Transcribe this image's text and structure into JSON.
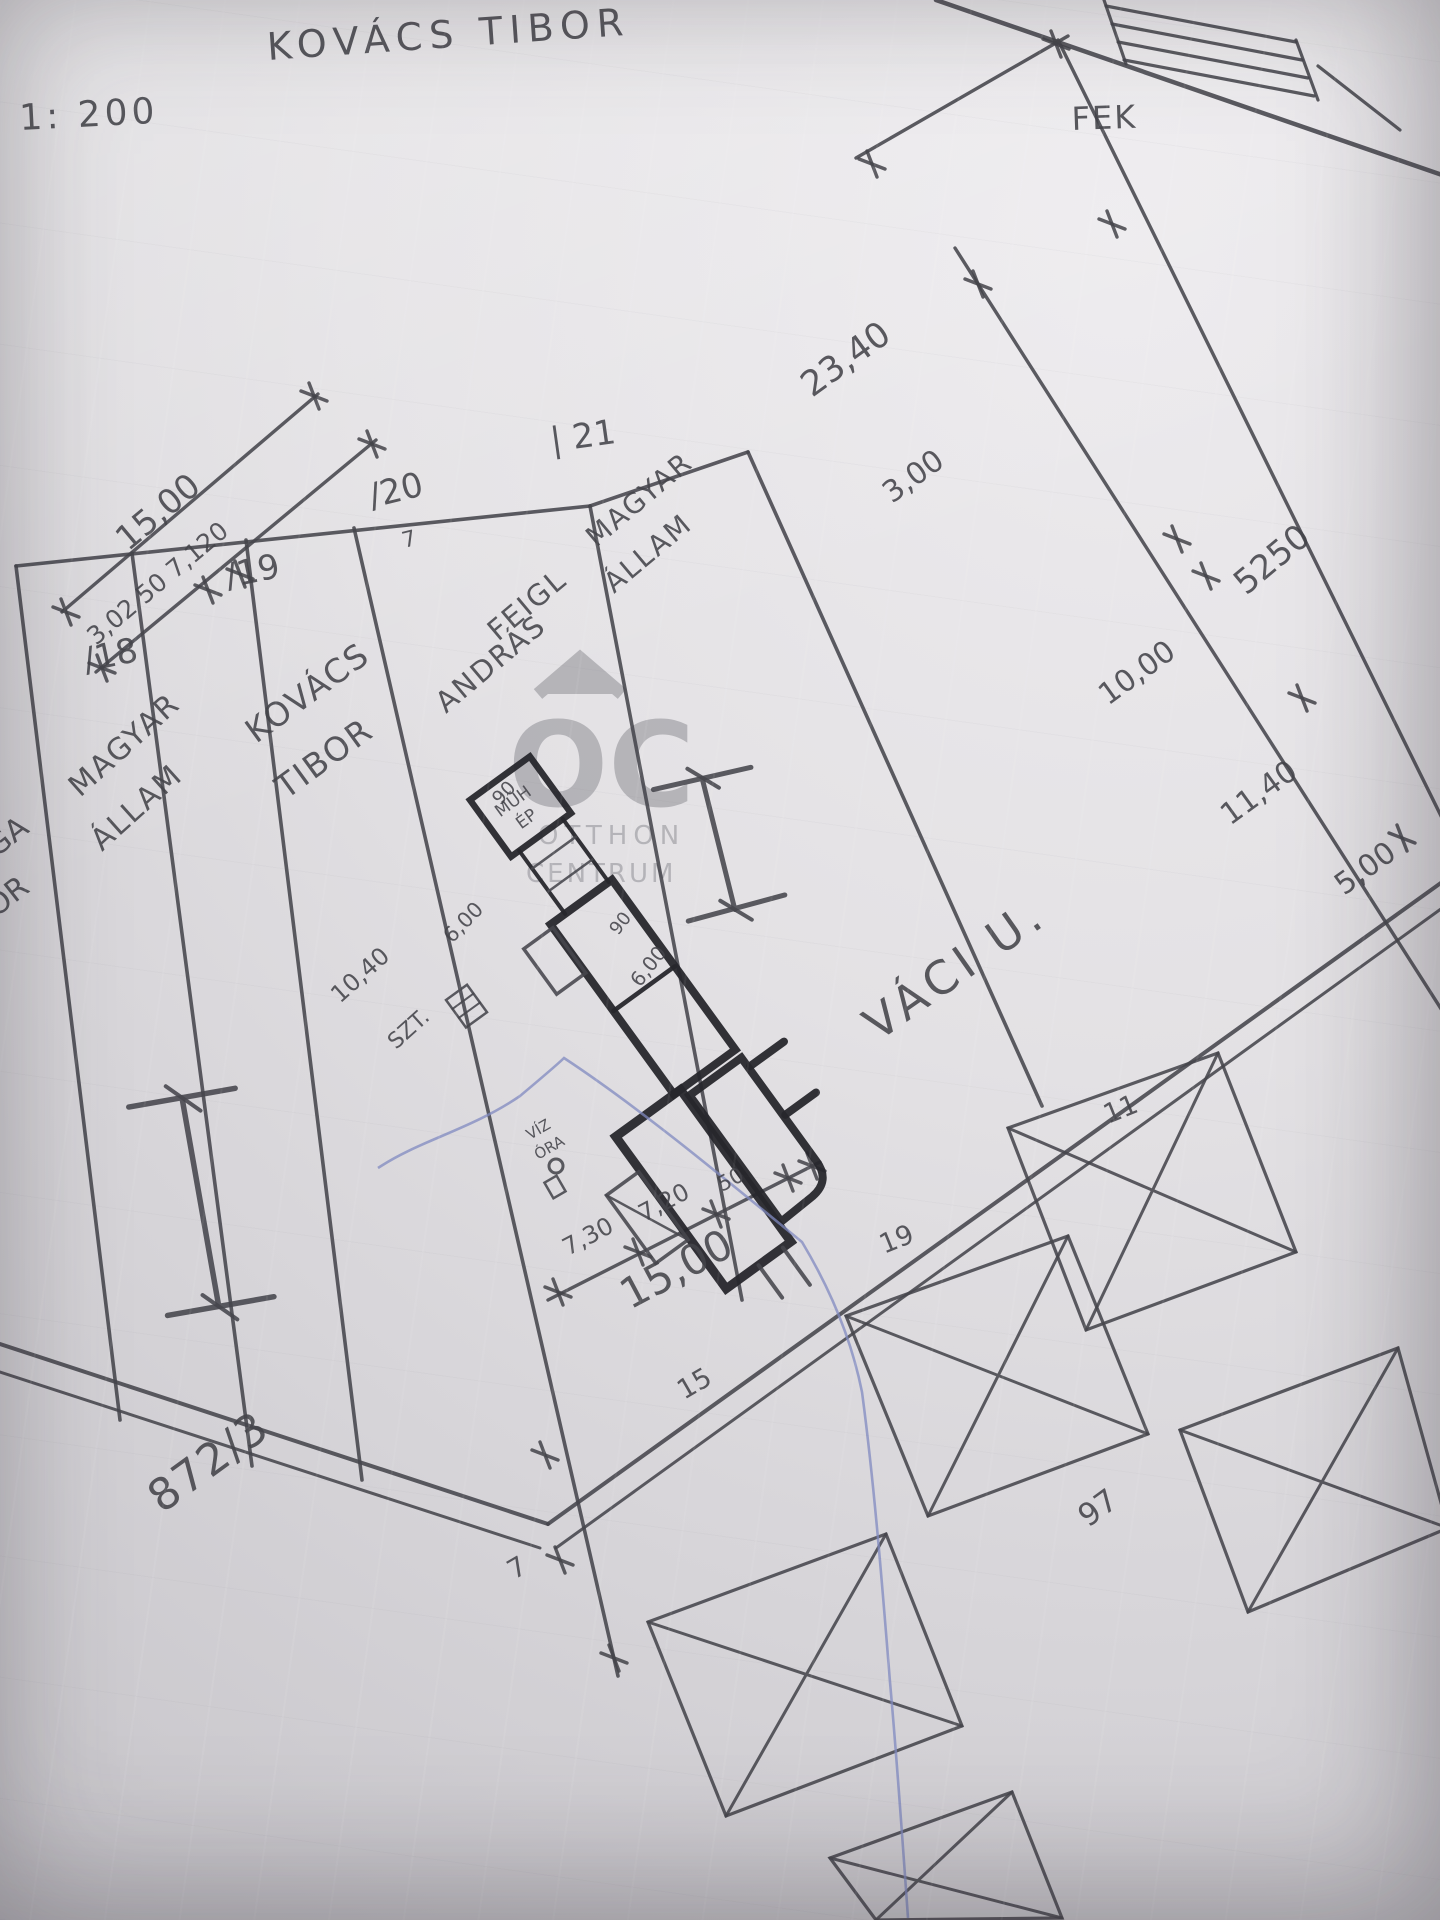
{
  "header": {
    "title": "KOVÁCS TIBOR",
    "scale": "1: 200",
    "corner_note": "FEK"
  },
  "watermark": {
    "monogram": "OC",
    "line1": "OTTHON",
    "line2": "CENTRUM"
  },
  "plots": {
    "p18_number": "/18",
    "p19_number": "/19",
    "p20_number": "/20",
    "p20_sub": "7",
    "p21_number": "| 21",
    "owner_18_line1": "MAGYAR",
    "owner_18_line2": "ÁLLAM",
    "owner_19_line1": "KOVÁCS",
    "owner_19_line2": "TIBOR",
    "owner_20_line1": "FEIGL",
    "owner_20_line2": "ANDRÁS",
    "owner_21_line1": "MAGYAR",
    "owner_21_line2": "ÁLLAM",
    "edge_partial_top": "GA",
    "edge_partial_bottom": "OR",
    "parcel_bottom_left": "872/3",
    "street_name": "VÁCI U.",
    "neighbor_numbers": [
      "11",
      "19",
      "15",
      "7",
      "97"
    ]
  },
  "dimensions": {
    "right_chain": [
      "23,40",
      "3,00",
      "10,00",
      "11,40",
      "5,00"
    ],
    "right_outer": "5250",
    "top_left_main": "15,00",
    "top_left_sub": "3,02 50 7,120",
    "bottom_chain": [
      "7,30",
      "7,20",
      "50"
    ],
    "bottom_total": "15,00",
    "inner_left": [
      "10,40",
      "6,00",
      "90"
    ],
    "inner_right": [
      "6,00",
      "90"
    ],
    "stairs_label": "SZT.",
    "workshop_line1": "MŰH",
    "workshop_line2": "ÉP",
    "water_meter_line1": "VÍZ",
    "water_meter_line2": "ÓRA"
  }
}
